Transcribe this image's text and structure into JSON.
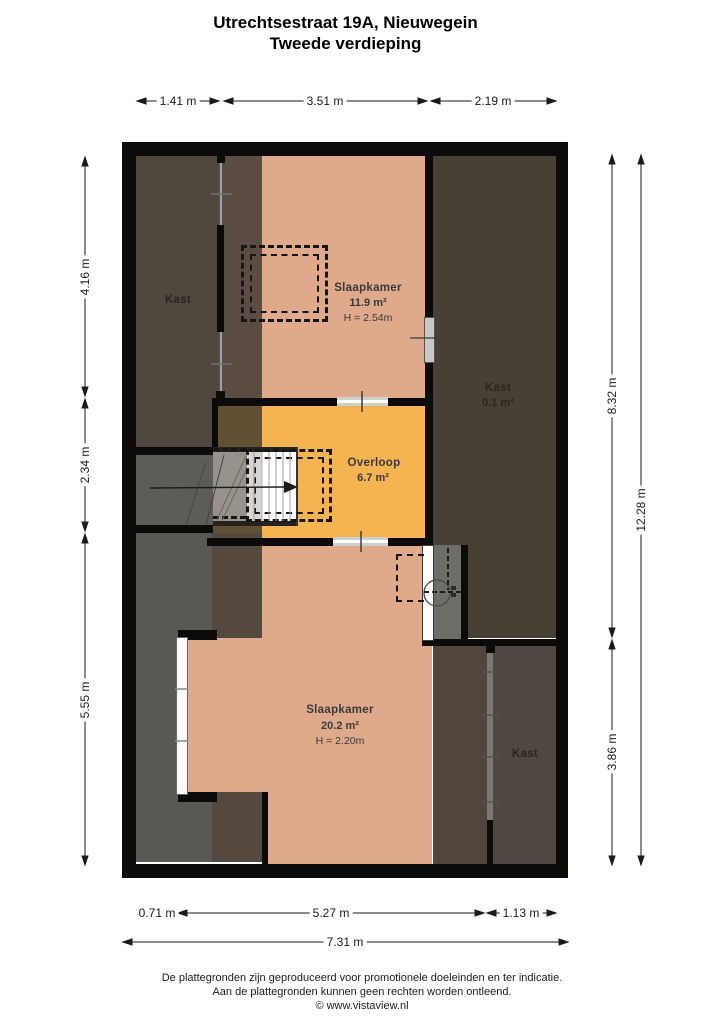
{
  "title": {
    "line1": "Utrechtsestraat 19A, Nieuwegein",
    "line2": "Tweede verdieping"
  },
  "rooms": {
    "kast_top_left": {
      "name": "Kast"
    },
    "slaapkamer_top": {
      "name": "Slaapkamer",
      "area": "11.9 m²",
      "height": "H = 2.54m"
    },
    "kast_top_right": {
      "name": "Kast",
      "area": "0.1 m²"
    },
    "overloop": {
      "name": "Overloop",
      "area": "6.7 m²"
    },
    "slaapkamer_bottom": {
      "name": "Slaapkamer",
      "area": "20.2 m²",
      "height": "H = 2.20m"
    },
    "kast_bottom_right": {
      "name": "Kast"
    }
  },
  "dimensions": {
    "top": [
      "1.41 m",
      "3.51 m",
      "2.19 m"
    ],
    "left": [
      "4.16 m",
      "2.34 m",
      "5.55 m"
    ],
    "right_inner": [
      "8.32 m",
      "3.86 m"
    ],
    "right_outer": "12.28 m",
    "bottom": [
      "0.71 m",
      "5.27 m",
      "1.13 m"
    ],
    "bottom_total": "7.31 m"
  },
  "footer": {
    "line1": "De plattegronden zijn geproduceerd voor promotionele doeleinden en ter indicatie.",
    "line2": "Aan de plattegronden kunnen geen rechten worden ontleend.",
    "line3": "© www.vistaview.nl"
  },
  "colors": {
    "wall": "#0d0b09",
    "floor_salmon": "#dfa98b",
    "floor_orange": "#f5b351",
    "kast_dark_olive": "#474034",
    "roof_gray": "#5a5855",
    "low_roof_brown": "#54493f"
  }
}
